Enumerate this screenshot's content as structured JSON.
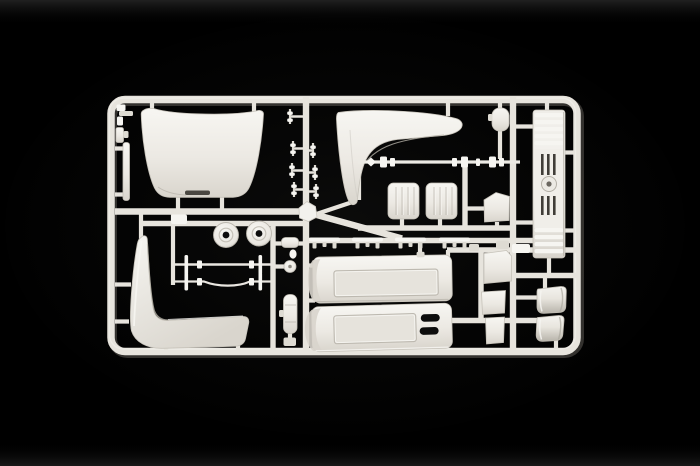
{
  "meta": {
    "type": "photograph",
    "subject": "White injection-molded model kit sprue (parts tree) with truck cab parts on a black background",
    "width_px": 700,
    "height_px": 466
  },
  "scene": {
    "colors": {
      "bg": "#000000",
      "bg-glow": "#262624",
      "plastic": "#e7e4dd",
      "plastic-bright": "#f6f5f1",
      "plastic-mid": "#dedbd3",
      "plastic-shadow": "#b5b1a8",
      "plastic-deep": "#8f8b83",
      "recess": "#e6e3dc",
      "hole": "#0d0d0d",
      "slot": "#403d38"
    },
    "sprue": {
      "frame_shape": "rounded rectangle runner frame",
      "material": "ivory white polystyrene",
      "parts": [
        {
          "name": "cab roof panel",
          "quantity": 1
        },
        {
          "name": "sun visor panel",
          "quantity": 1
        },
        {
          "name": "radiator grille panel",
          "quantity": 1
        },
        {
          "name": "upper door panel",
          "quantity": 1
        },
        {
          "name": "lower door panel",
          "quantity": 1
        },
        {
          "name": "side skirt panel",
          "quantity": 1
        },
        {
          "name": "ribbed seat back",
          "quantity": 2
        },
        {
          "name": "wheel hub disc",
          "quantity": 2
        },
        {
          "name": "axle rod with collars",
          "quantity": 1
        },
        {
          "name": "wiper arm rod",
          "quantity": 2
        },
        {
          "name": "mudguard section",
          "quantity": 2
        },
        {
          "name": "mounting clip",
          "quantity": 4
        },
        {
          "name": "small rectangular panel",
          "quantity": 3
        },
        {
          "name": "small fittings and pins",
          "quantity": "several"
        }
      ]
    }
  }
}
